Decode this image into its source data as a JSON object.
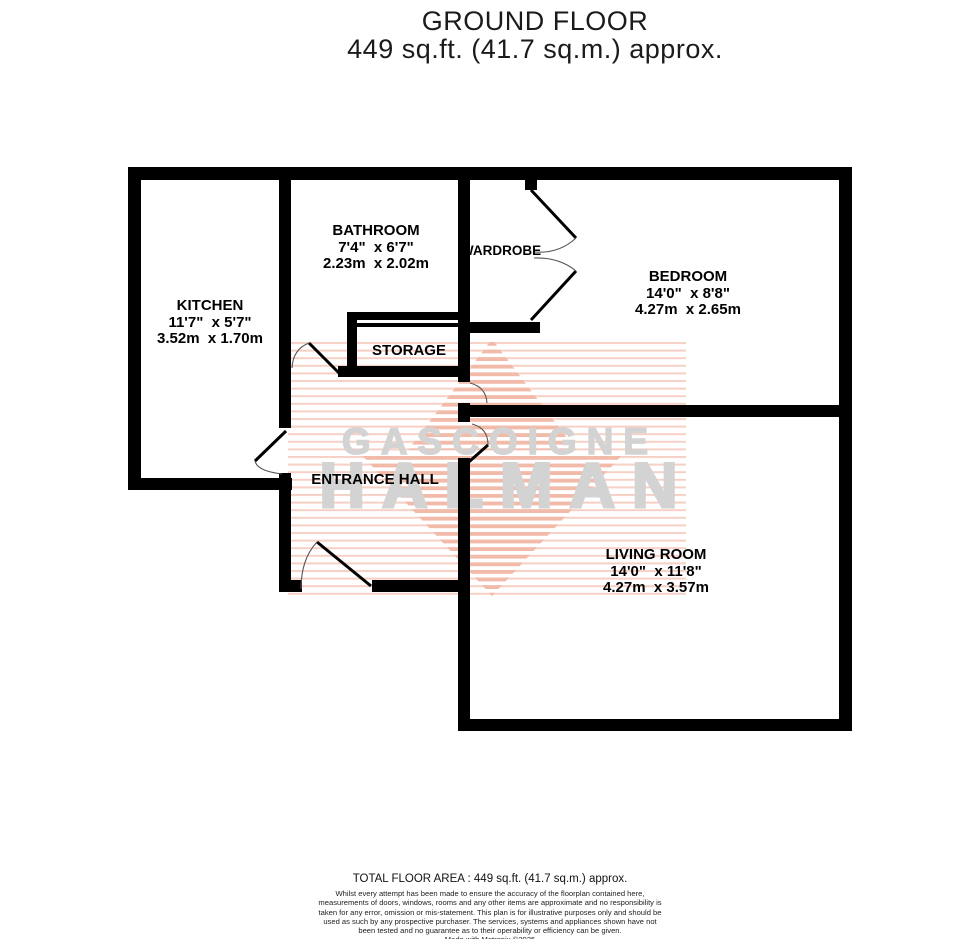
{
  "title": {
    "line1": "GROUND FLOOR",
    "line2": "449 sq.ft. (41.7 sq.m.) approx."
  },
  "watermark": {
    "line1": "GASCOIGNE",
    "line2": "HALMAN"
  },
  "rooms": {
    "kitchen": {
      "name": "KITCHEN",
      "imperial": "11'7\"  x 5'7\"",
      "metric": "3.52m  x 1.70m"
    },
    "bathroom": {
      "name": "BATHROOM",
      "imperial": "7'4\"  x 6'7\"",
      "metric": "2.23m  x 2.02m"
    },
    "wardrobe": {
      "name": "WARDROBE"
    },
    "bedroom": {
      "name": "BEDROOM",
      "imperial": "14'0\"  x 8'8\"",
      "metric": "4.27m  x 2.65m"
    },
    "storage": {
      "name": "STORAGE"
    },
    "entrance_hall": {
      "name": "ENTRANCE HALL"
    },
    "living_room": {
      "name": "LIVING ROOM",
      "imperial": "14'0\"  x 11'8\"",
      "metric": "4.27m  x 3.57m"
    }
  },
  "footer": {
    "total_area": "TOTAL FLOOR AREA : 449 sq.ft. (41.7 sq.m.) approx.",
    "disclaimer": "Whilst every attempt has been made to ensure the accuracy of the floorplan contained here, measurements of doors, windows, rooms and any other items are approximate and no responsibility is taken for any error, omission or mis-statement. This plan is for illustrative purposes only and should be used as such by any prospective purchaser. The services, systems and appliances shown have not been tested and no guarantee as to their operability or efficiency can be given.",
    "credit": "Made with Metropix ©2025"
  },
  "colors": {
    "wall": "#000000",
    "watermark_text": "#d3d3d3",
    "stripe_light": "#f6d0c5",
    "stripe_strong": "#f2baa9"
  }
}
